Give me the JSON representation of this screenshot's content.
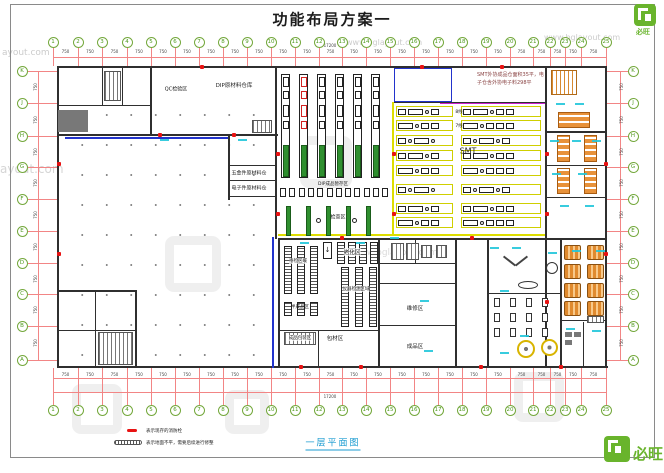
{
  "title": "功能布局方案一",
  "sheet": {
    "plan_label": "一层平面图"
  },
  "grid": {
    "cols": [
      "1",
      "2",
      "3",
      "4",
      "5",
      "6",
      "7",
      "8",
      "9",
      "10",
      "11",
      "12",
      "13",
      "14",
      "15",
      "16",
      "17",
      "18",
      "19",
      "20",
      "21",
      "22",
      "23",
      "24",
      "25"
    ],
    "rows": [
      "K",
      "J",
      "H",
      "G",
      "F",
      "E",
      "D",
      "C",
      "B",
      "A"
    ],
    "dim_segment": "750",
    "dim_total": "17200"
  },
  "zones": {
    "qc": "QC检验区",
    "dip_warehouse": "DIP原材料仓库",
    "hardware_warehouse": "五金件原材料仓",
    "electronic_warehouse": "电子件原材料仓",
    "dip_line": "DIP成品暂存区",
    "inspection": "检查区",
    "smt": "SMT",
    "smt_line8": "8线",
    "smt_line7": "7线",
    "aging": "老化区",
    "pending": "待检区域",
    "instrument": "仪器检测区域",
    "semi_finished": "半成品区",
    "packing": "成品包装区",
    "packing_material": "包材区",
    "repair": "维修区",
    "finished": "成品区"
  },
  "notes": {
    "smt_note": "SMT外协成品仓面积35平，电子仓含外协电子料298平"
  },
  "legend": {
    "items": [
      {
        "icon": "fire-hydrant-mark",
        "text": "表示现存的消防栓"
      },
      {
        "icon": "uneven-floor-hatch",
        "text": "表示地面不平，需要后续进行修整"
      }
    ]
  },
  "watermark": {
    "brand": "必旺",
    "url": "www.bglayout.com",
    "partial_url": "ayout.com"
  },
  "icons": {
    "aging_arrow": "↓"
  },
  "colors": {
    "grid_bubble": "#74a83c",
    "dim_red": "#f28585",
    "hydrant_red": "#e81212",
    "machine_green": "#2f8f2f",
    "smt_yellow": "#dede00",
    "furniture_orange": "#e8923a",
    "cyan_label": "#22c6da",
    "blue_line": "#2233cc",
    "wall": "#2f2f2f",
    "watermark_green": "#69b42c",
    "plan_label_blue": "#1b9bd0"
  }
}
